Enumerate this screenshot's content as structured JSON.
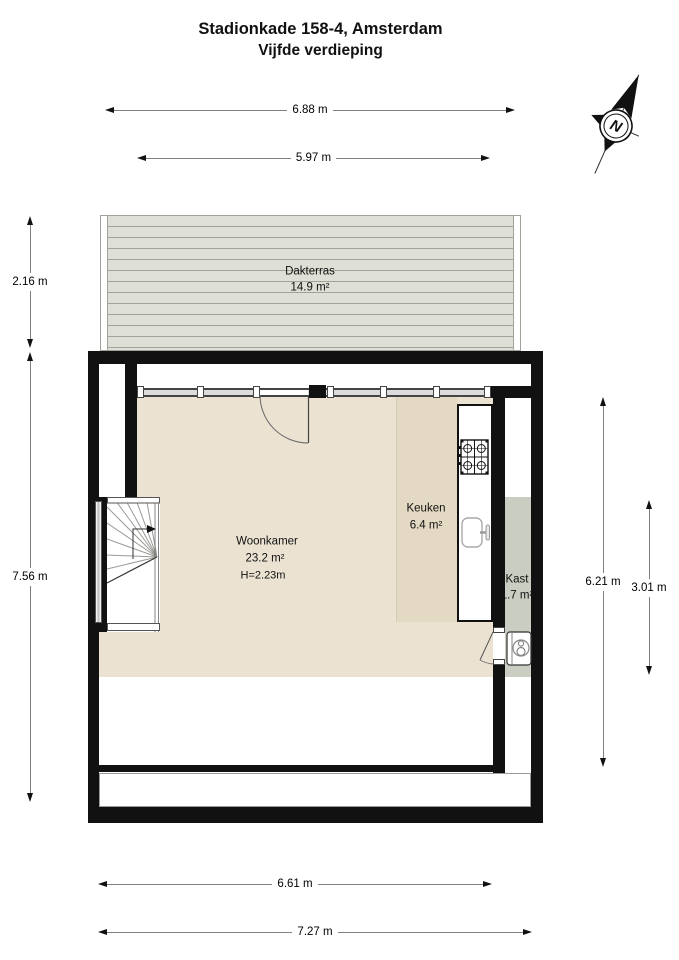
{
  "title": {
    "line1": "Stadionkade 158-4, Amsterdam",
    "line2": "Vijfde verdieping"
  },
  "compass": {
    "label": "N"
  },
  "dimensions": {
    "top": [
      {
        "label": "6.88 m"
      },
      {
        "label": "5.97 m"
      }
    ],
    "left": [
      {
        "label": "2.16 m"
      },
      {
        "label": "7.56 m"
      }
    ],
    "right": [
      {
        "label": "6.21 m"
      },
      {
        "label": "3.01 m"
      }
    ],
    "bottom": [
      {
        "label": "6.61 m"
      },
      {
        "label": "7.27 m"
      }
    ]
  },
  "rooms": {
    "dakterras": {
      "name": "Dakterras",
      "area": "14.9 m²"
    },
    "woonkamer": {
      "name": "Woonkamer",
      "area": "23.2 m²",
      "ceiling_height": "H=2.23m"
    },
    "keuken": {
      "name": "Keuken",
      "area": "6.4 m²"
    },
    "kast": {
      "name": "Kast",
      "area": "1.7 m²"
    }
  },
  "colors": {
    "wall": "#111111",
    "floor": "#EBE2D2",
    "keuken_floor": "#E4D9C3",
    "kast_floor": "#C9CDC2",
    "deck_board": "#DEDFD7",
    "deck_gap": "#A2A29A",
    "dim_line": "#808080",
    "glass": "#DCDCDC"
  }
}
